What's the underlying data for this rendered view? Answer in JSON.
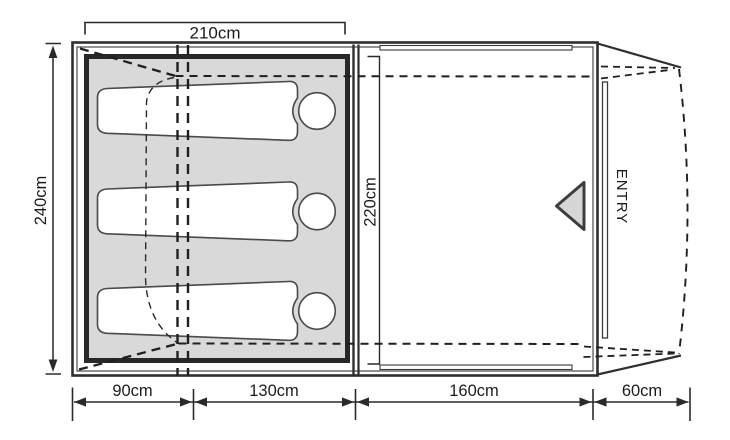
{
  "diagram": {
    "kind": "tent floor plan",
    "dimensions": {
      "top_width": {
        "label": "210cm"
      },
      "left_height": {
        "label": "240cm"
      },
      "inner_height": {
        "label": "220cm"
      },
      "bottom_segments": [
        {
          "label": "90cm"
        },
        {
          "label": "130cm"
        },
        {
          "label": "160cm"
        },
        {
          "label": "60cm"
        }
      ]
    },
    "entry": {
      "label": "ENTRY"
    },
    "figures": {
      "sleeping_bag_count": 3
    },
    "colors": {
      "line": "#2e2e2e",
      "dashed_line": "#1f1f1f",
      "bedroom_fill": "#d9d9d9",
      "triangle_fill": "#d6d6d6",
      "background": "#ffffff"
    }
  }
}
